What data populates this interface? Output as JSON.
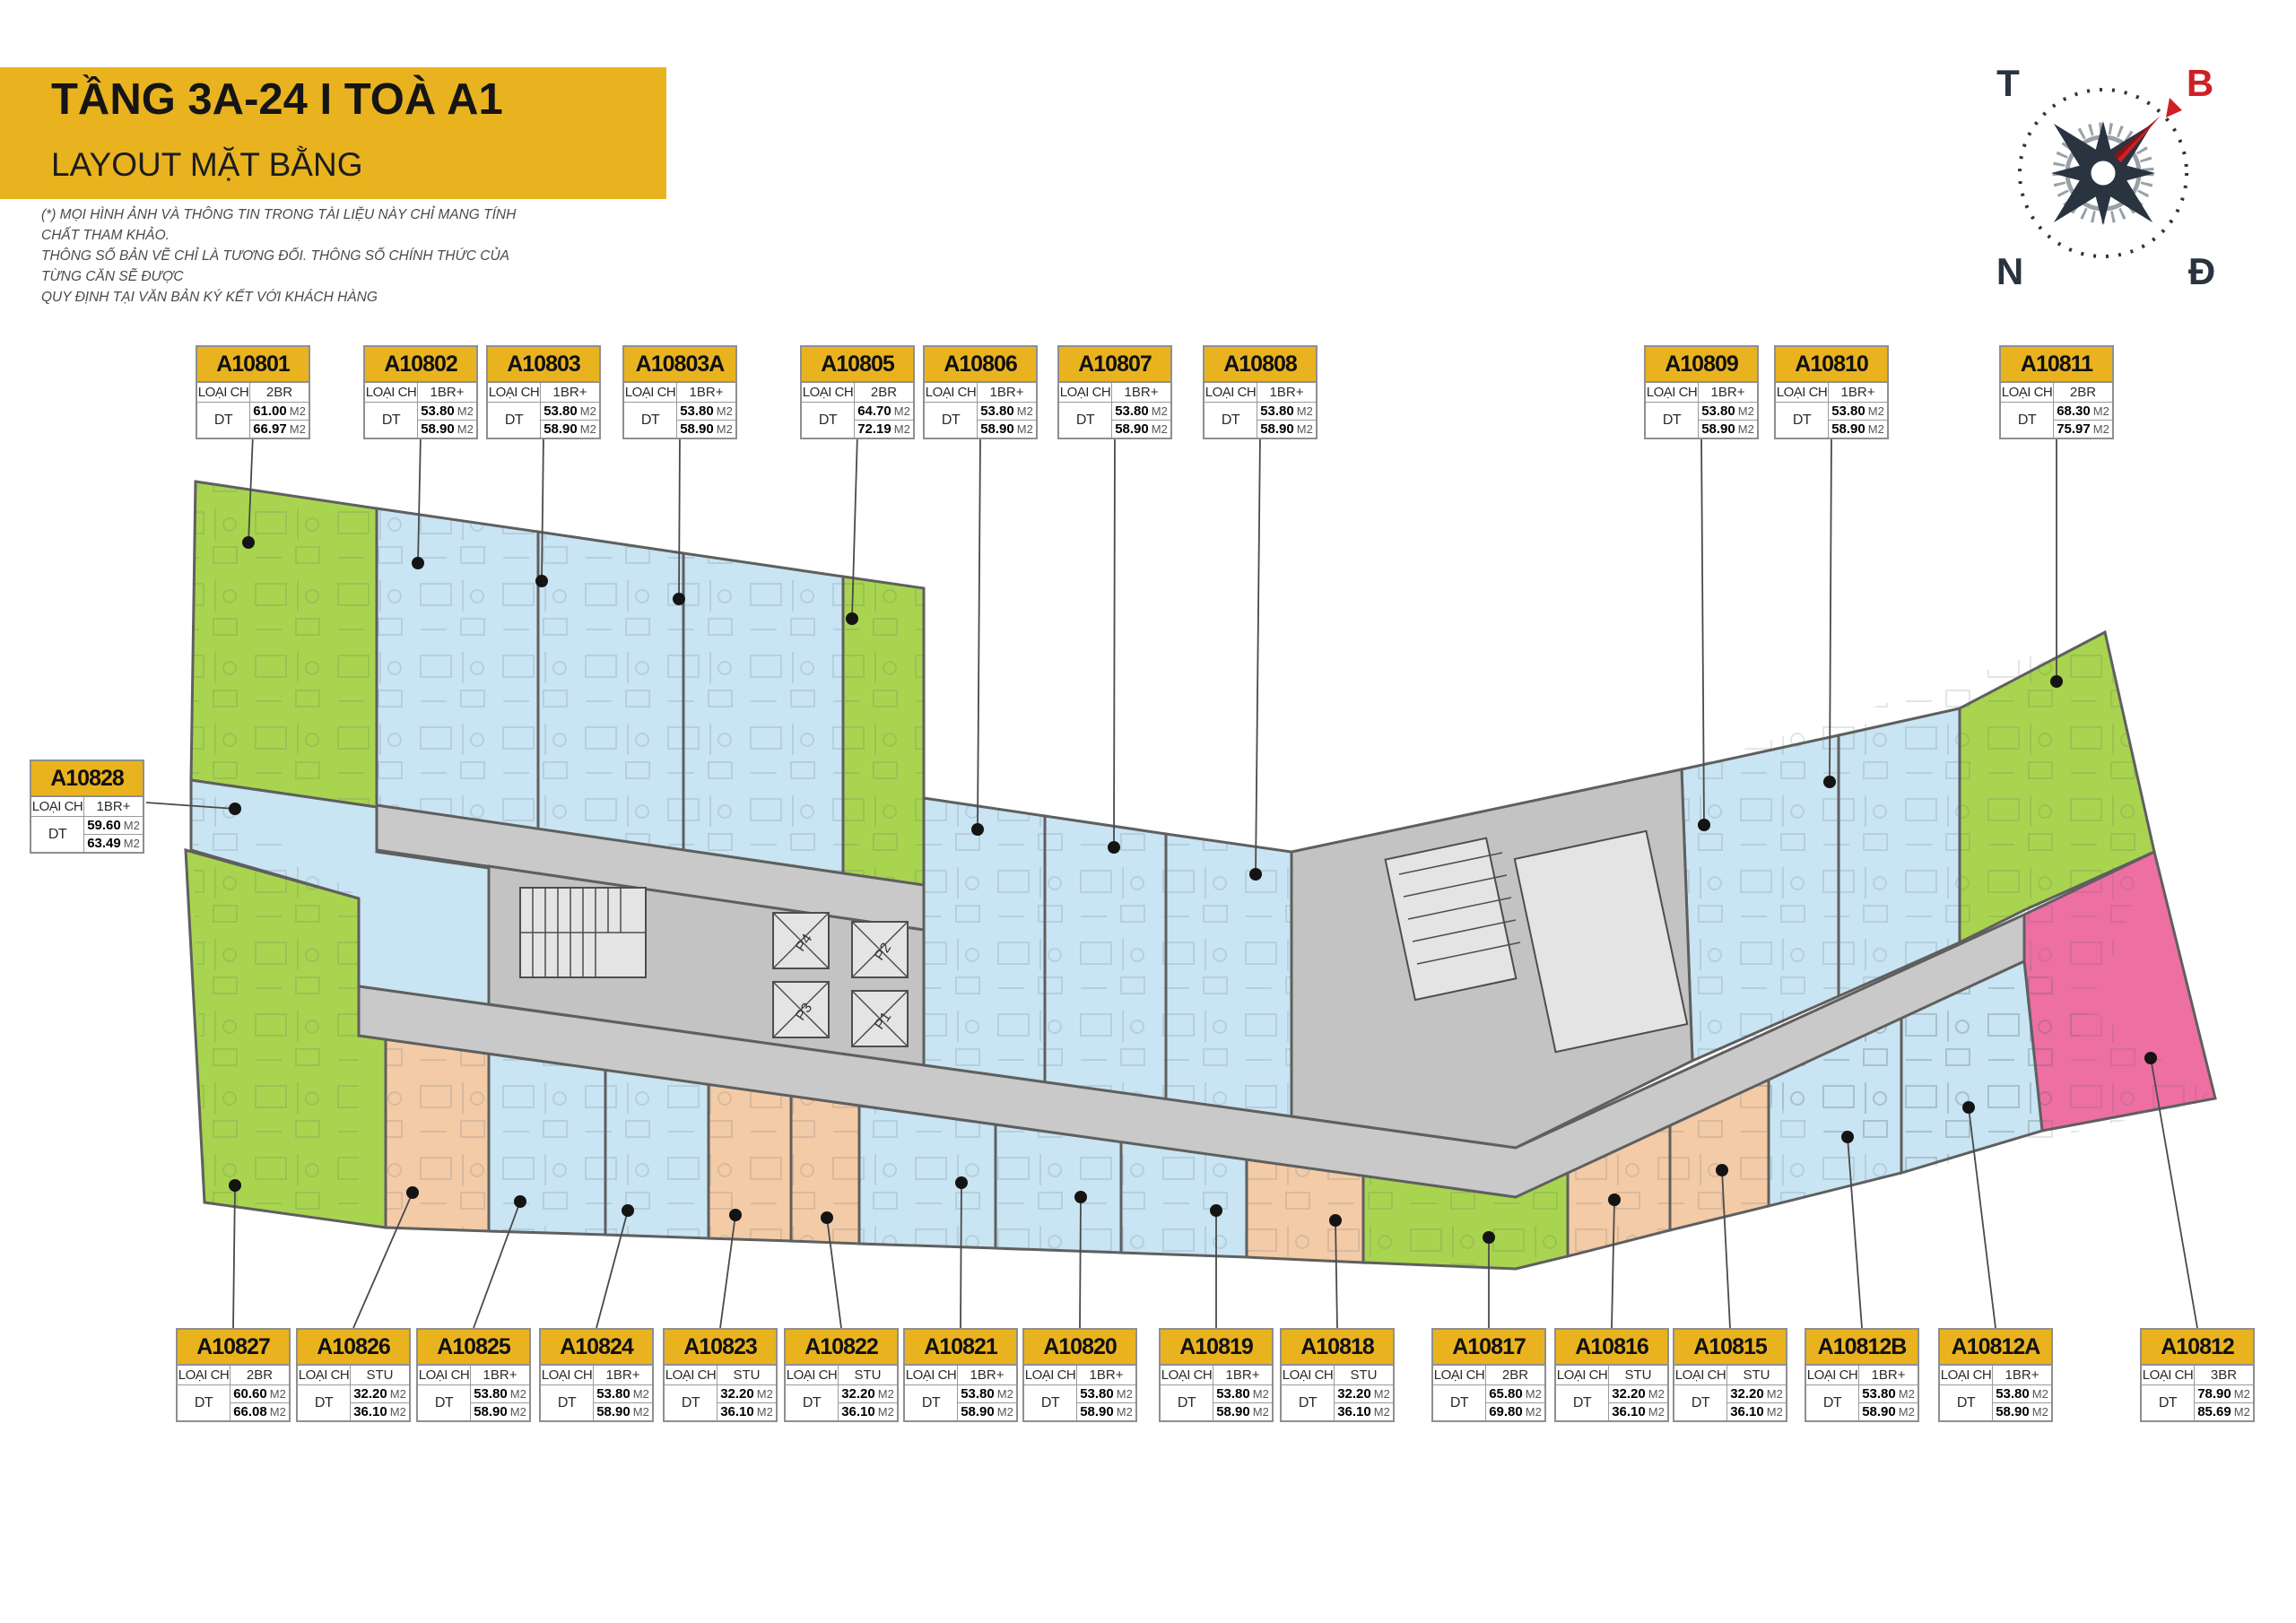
{
  "header": {
    "title": "TẦNG 3A-24  I  TOÀ A1",
    "subtitle": "LAYOUT MẶT BẰNG"
  },
  "disclaimer": {
    "line1": "(*) MỌI HÌNH ẢNH VÀ THÔNG TIN TRONG TÀI LIỆU NÀY CHỈ MANG TÍNH CHẤT THAM KHẢO.",
    "line2": "THÔNG SỐ BẢN VẼ CHỈ LÀ TƯƠNG ĐỐI. THÔNG SỐ CHÍNH THỨC CỦA TỪNG CĂN SẼ ĐƯỢC",
    "line3": "QUY ĐỊNH TẠI VĂN BẢN KÝ KẾT VỚI KHÁCH HÀNG"
  },
  "compass": {
    "west": "T",
    "north": "B",
    "south": "N",
    "east": "Đ"
  },
  "card_labels": {
    "type_label": "LOẠI CH",
    "area_label": "DT",
    "area_unit": "M2"
  },
  "core_labels": {
    "elevators": [
      "P1",
      "P2",
      "P3",
      "P4"
    ]
  },
  "palette": {
    "green": "#a9d44f",
    "blue": "#c9e4f2",
    "peach": "#f3cba7",
    "pink": "#ee6fa2",
    "corridor": "#c9c9c9",
    "core": "#c3c3c3",
    "wall": "#5f5f5f",
    "card_yellow": "#e9b320",
    "accent_red": "#cf1f26",
    "compass_dark": "#2a3340"
  },
  "unit_type_colors": {
    "STU": "peach",
    "1BR+": "blue",
    "2BR": "green",
    "3BR": "pink"
  },
  "units": [
    {
      "code": "A10801",
      "type": "2BR",
      "area1": "61.00",
      "area2": "66.97"
    },
    {
      "code": "A10802",
      "type": "1BR+",
      "area1": "53.80",
      "area2": "58.90"
    },
    {
      "code": "A10803",
      "type": "1BR+",
      "area1": "53.80",
      "area2": "58.90"
    },
    {
      "code": "A10803A",
      "type": "1BR+",
      "area1": "53.80",
      "area2": "58.90"
    },
    {
      "code": "A10805",
      "type": "2BR",
      "area1": "64.70",
      "area2": "72.19"
    },
    {
      "code": "A10806",
      "type": "1BR+",
      "area1": "53.80",
      "area2": "58.90"
    },
    {
      "code": "A10807",
      "type": "1BR+",
      "area1": "53.80",
      "area2": "58.90"
    },
    {
      "code": "A10808",
      "type": "1BR+",
      "area1": "53.80",
      "area2": "58.90"
    },
    {
      "code": "A10809",
      "type": "1BR+",
      "area1": "53.80",
      "area2": "58.90"
    },
    {
      "code": "A10810",
      "type": "1BR+",
      "area1": "53.80",
      "area2": "58.90"
    },
    {
      "code": "A10811",
      "type": "2BR",
      "area1": "68.30",
      "area2": "75.97"
    },
    {
      "code": "A10828",
      "type": "1BR+",
      "area1": "59.60",
      "area2": "63.49"
    },
    {
      "code": "A10827",
      "type": "2BR",
      "area1": "60.60",
      "area2": "66.08"
    },
    {
      "code": "A10826",
      "type": "STU",
      "area1": "32.20",
      "area2": "36.10"
    },
    {
      "code": "A10825",
      "type": "1BR+",
      "area1": "53.80",
      "area2": "58.90"
    },
    {
      "code": "A10824",
      "type": "1BR+",
      "area1": "53.80",
      "area2": "58.90"
    },
    {
      "code": "A10823",
      "type": "STU",
      "area1": "32.20",
      "area2": "36.10"
    },
    {
      "code": "A10822",
      "type": "STU",
      "area1": "32.20",
      "area2": "36.10"
    },
    {
      "code": "A10821",
      "type": "1BR+",
      "area1": "53.80",
      "area2": "58.90"
    },
    {
      "code": "A10820",
      "type": "1BR+",
      "area1": "53.80",
      "area2": "58.90"
    },
    {
      "code": "A10819",
      "type": "1BR+",
      "area1": "53.80",
      "area2": "58.90"
    },
    {
      "code": "A10818",
      "type": "STU",
      "area1": "32.20",
      "area2": "36.10"
    },
    {
      "code": "A10817",
      "type": "2BR",
      "area1": "65.80",
      "area2": "69.80"
    },
    {
      "code": "A10816",
      "type": "STU",
      "area1": "32.20",
      "area2": "36.10"
    },
    {
      "code": "A10815",
      "type": "STU",
      "area1": "32.20",
      "area2": "36.10"
    },
    {
      "code": "A10812B",
      "type": "1BR+",
      "area1": "53.80",
      "area2": "58.90"
    },
    {
      "code": "A10812A",
      "type": "1BR+",
      "area1": "53.80",
      "area2": "58.90"
    },
    {
      "code": "A10812",
      "type": "3BR",
      "area1": "78.90",
      "area2": "85.69"
    }
  ]
}
